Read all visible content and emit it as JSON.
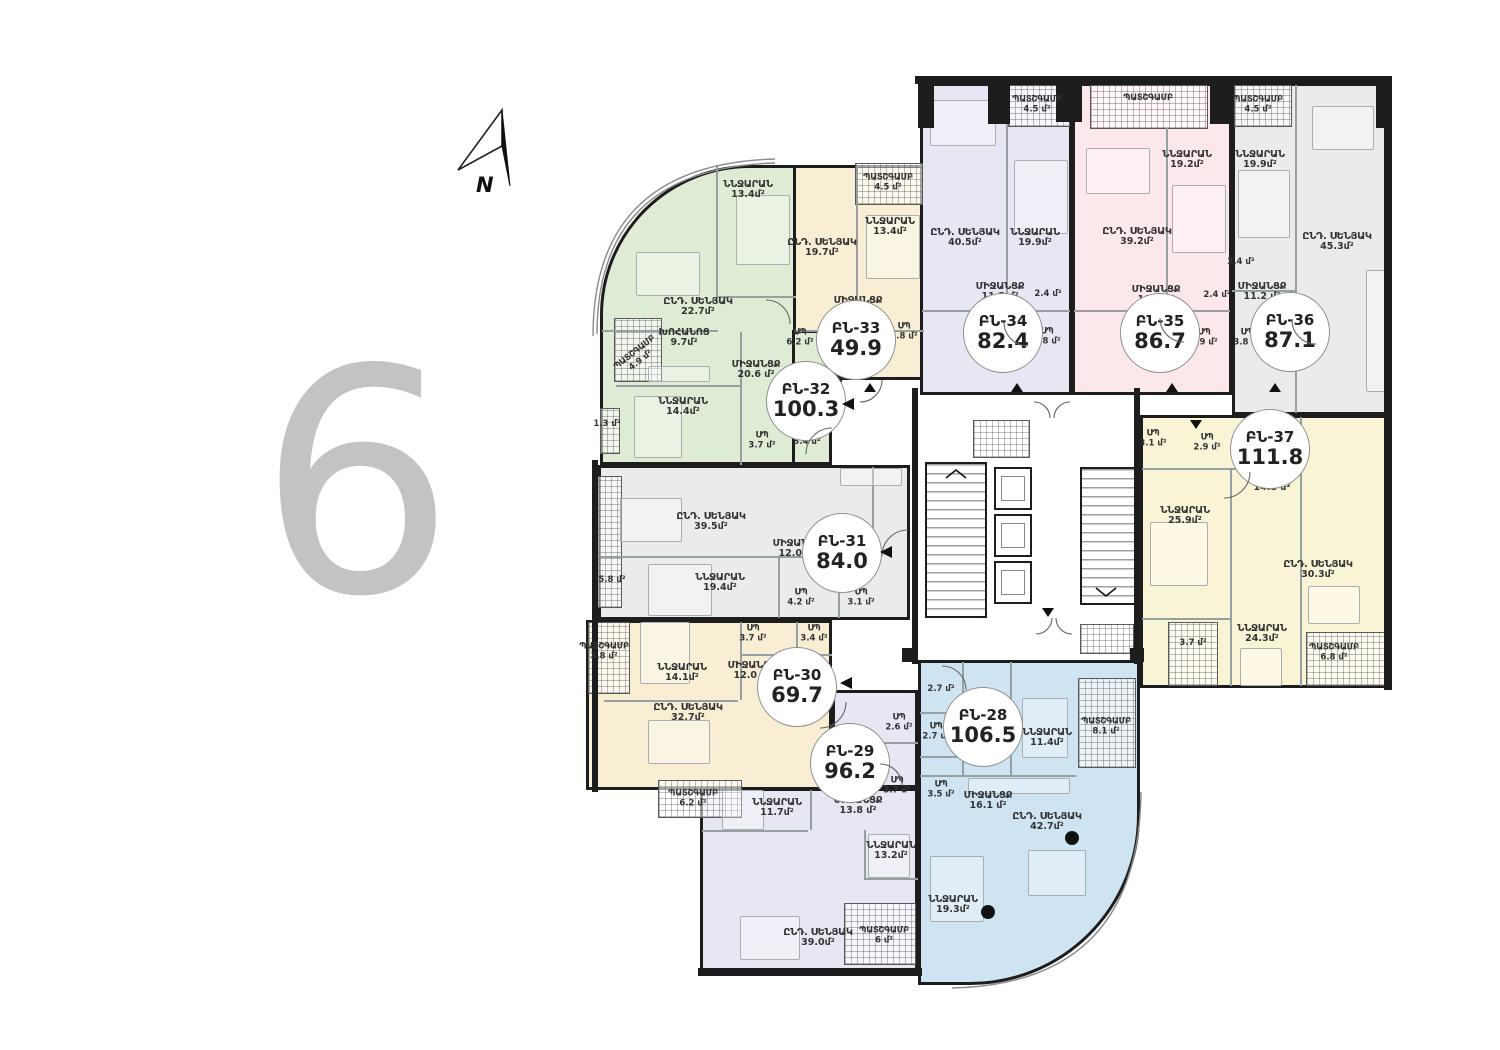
{
  "floor": {
    "number": "6"
  },
  "compass": {
    "label": "N"
  },
  "palette": {
    "wall": "#1d1d1d",
    "floor_number": "#c3c3c3",
    "blue": "#cfe4f2",
    "lavender": "#e7e7f4",
    "cream": "#f8eed3",
    "gray": "#eaecec",
    "green": "#dfecd5",
    "pink": "#fce8eb",
    "yellow": "#faf4d6"
  },
  "apartments": [
    {
      "id": "ԲՆ-28",
      "total": "106.5",
      "color": "#cfe4f2",
      "rooms": [
        {
          "name": "ՆՆՋԱՐԱՆ",
          "area": "11.4մ²"
        },
        {
          "name": "ՆՆՋԱՐԱՆ",
          "area": "19.3մ²"
        },
        {
          "name": "ԸՆԴ. ՍԵՆՅԱԿ",
          "area": "42.7մ²"
        },
        {
          "name": "ՄԻՋԱՆՑՔ",
          "area": "16.1 մ²"
        },
        {
          "name": "ՊԱՏՇԳԱՄԲ",
          "area": "8.1 մ²"
        },
        {
          "name": "ՍՊ",
          "area": "2.7 մ²"
        },
        {
          "name": "ՍՊ",
          "area": "3.5 մ²"
        },
        {
          "name": "",
          "area": "2.7 մ²"
        }
      ]
    },
    {
      "id": "ԲՆ-29",
      "total": "96.2",
      "color": "#e7e7f4",
      "rooms": [
        {
          "name": "ՆՆՋԱՐԱՆ",
          "area": "11.7մ²"
        },
        {
          "name": "ՆՆՋԱՐԱՆ",
          "area": "13.2մ²"
        },
        {
          "name": "ԸՆԴ. ՍԵՆՅԱԿ",
          "area": "39.0մ²"
        },
        {
          "name": "ՄԻՋԱՆՑՔ",
          "area": "13.8 մ²"
        },
        {
          "name": "ՊԱՏՇԳԱՄԲ",
          "area": "6.2 մ²"
        },
        {
          "name": "ՊԱՏՇԳԱՄԲ",
          "area": "6 մ²"
        },
        {
          "name": "ՍՊ",
          "area": "2.6 մ²"
        },
        {
          "name": "ՍՊ",
          "area": "3.7 մ²"
        }
      ]
    },
    {
      "id": "ԲՆ-30",
      "total": "69.7",
      "color": "#f8eed3",
      "rooms": [
        {
          "name": "ՆՆՋԱՐԱՆ",
          "area": "14.1մ²"
        },
        {
          "name": "ԸՆԴ. ՍԵՆՅԱԿ",
          "area": "32.7մ²"
        },
        {
          "name": "ՄԻՋԱՆՑՔ",
          "area": "12.0 մ²"
        },
        {
          "name": "ՊԱՏՇԳԱՄԲ",
          "area": "3.8 մ²"
        },
        {
          "name": "ՍՊ",
          "area": "3.7 մ²"
        },
        {
          "name": "ՍՊ",
          "area": "3.4 մ²"
        }
      ]
    },
    {
      "id": "ԲՆ-31",
      "total": "84.0",
      "color": "#eaecec",
      "rooms": [
        {
          "name": "ԸՆԴ. ՍԵՆՅԱԿ",
          "area": "39.5մ²"
        },
        {
          "name": "ՆՆՋԱՐԱՆ",
          "area": "19.4մ²"
        },
        {
          "name": "ՄԻՋԱՆՑՔ",
          "area": "12.0 մ²"
        },
        {
          "name": "ՍՊ",
          "area": "4.2 մ²"
        },
        {
          "name": "ՍՊ",
          "area": "3.1 մ²"
        },
        {
          "name": "",
          "area": "5.8 մ²"
        }
      ]
    },
    {
      "id": "ԲՆ-32",
      "total": "100.3",
      "color": "#dfecd5",
      "rooms": [
        {
          "name": "ՆՆՋԱՐԱՆ",
          "area": "13.4մ²"
        },
        {
          "name": "ՆՆՋԱՐԱՆ",
          "area": "14.4մ²"
        },
        {
          "name": "ԸՆԴ. ՍԵՆՅԱԿ",
          "area": "22.7մ²"
        },
        {
          "name": "ԽՈՀԱՆՈՑ",
          "area": "9.7մ²"
        },
        {
          "name": "ՄԻՋԱՆՑՔ",
          "area": "20.6 մ²"
        },
        {
          "name": "ՊԱՏՇԳԱՄԲ",
          "area": "4.9 մ²"
        },
        {
          "name": "ՍՊ",
          "area": "6.2 մ²"
        },
        {
          "name": "ՍՊ",
          "area": "3.7 մ²"
        },
        {
          "name": "",
          "area": "3.4 մ²"
        },
        {
          "name": "",
          "area": "1.3 մ²"
        }
      ]
    },
    {
      "id": "ԲՆ-33",
      "total": "49.9",
      "color": "#f8eed3",
      "rooms": [
        {
          "name": "ՆՆՋԱՐԱՆ",
          "area": "13.4մ²"
        },
        {
          "name": "ԸՆԴ. ՍԵՆՅԱԿ",
          "area": "19.7մ²"
        },
        {
          "name": "ՄԻՋԱՆՑՔ",
          "area": "8.5 մ²"
        },
        {
          "name": "ՊԱՏՇԳԱՄԲ",
          "area": "4.5 մ²"
        },
        {
          "name": "ՍՊ",
          "area": "3.8 մ²"
        }
      ]
    },
    {
      "id": "ԲՆ-34",
      "total": "82.4",
      "color": "#e7e7f4",
      "rooms": [
        {
          "name": "ԸՆԴ. ՍԵՆՅԱԿ",
          "area": "40.5մ²"
        },
        {
          "name": "ՆՆՋԱՐԱՆ",
          "area": "19.9մ²"
        },
        {
          "name": "ՄԻՋԱՆՑՔ",
          "area": "11.3 մ²"
        },
        {
          "name": "ՊԱՏՇԳԱՄԲ",
          "area": "4.5 մ²"
        },
        {
          "name": "ՍՊ",
          "area": "3.8 մ²"
        },
        {
          "name": "",
          "area": "2.4 մ²"
        }
      ]
    },
    {
      "id": "ԲՆ-35",
      "total": "86.7",
      "color": "#fce8eb",
      "rooms": [
        {
          "name": "ԸՆԴ. ՍԵՆՅԱԿ",
          "area": "39.2մ²"
        },
        {
          "name": "ՆՆՋԱՐԱՆ",
          "area": "19.2մ²"
        },
        {
          "name": "ՄԻՋԱՆՑՔ",
          "area": "10.8 մ²"
        },
        {
          "name": "ՊԱՏՇԳԱՄԲ",
          "area": ""
        },
        {
          "name": "ՍՊ",
          "area": "3.9 մ²"
        },
        {
          "name": "",
          "area": "2.4 մ²"
        }
      ]
    },
    {
      "id": "ԲՆ-36",
      "total": "87.1",
      "color": "#eaecec",
      "rooms": [
        {
          "name": "ԸՆԴ. ՍԵՆՅԱԿ",
          "area": "45.3մ²"
        },
        {
          "name": "ՆՆՋԱՐԱՆ",
          "area": "19.9մ²"
        },
        {
          "name": "ՄԻՋԱՆՑՔ",
          "area": "11.2 մ²"
        },
        {
          "name": "ՊԱՏՇԳԱՄԲ",
          "area": "4.5 մ²"
        },
        {
          "name": "ՍՊ",
          "area": "3.8 մ²"
        },
        {
          "name": "",
          "area": "2.4 մ²"
        }
      ]
    },
    {
      "id": "ԲՆ-37",
      "total": "111.8",
      "color": "#faf4d6",
      "rooms": [
        {
          "name": "ՆՆՋԱՐԱՆ",
          "area": "25.9մ²"
        },
        {
          "name": "ՆՆՋԱՐԱՆ",
          "area": "24.3մ²"
        },
        {
          "name": "ԸՆԴ. ՍԵՆՅԱԿ",
          "area": "30.3մ²"
        },
        {
          "name": "ՄԻՋԱՆՑՔ",
          "area": "14.8 մ²"
        },
        {
          "name": "ՊԱՏՇԳԱՄԲ",
          "area": "6.8 մ²"
        },
        {
          "name": "ՍՊ",
          "area": "3.1 մ²"
        },
        {
          "name": "ՍՊ",
          "area": "2.9 մ²"
        },
        {
          "name": "",
          "area": "3.7 մ²"
        }
      ]
    }
  ]
}
